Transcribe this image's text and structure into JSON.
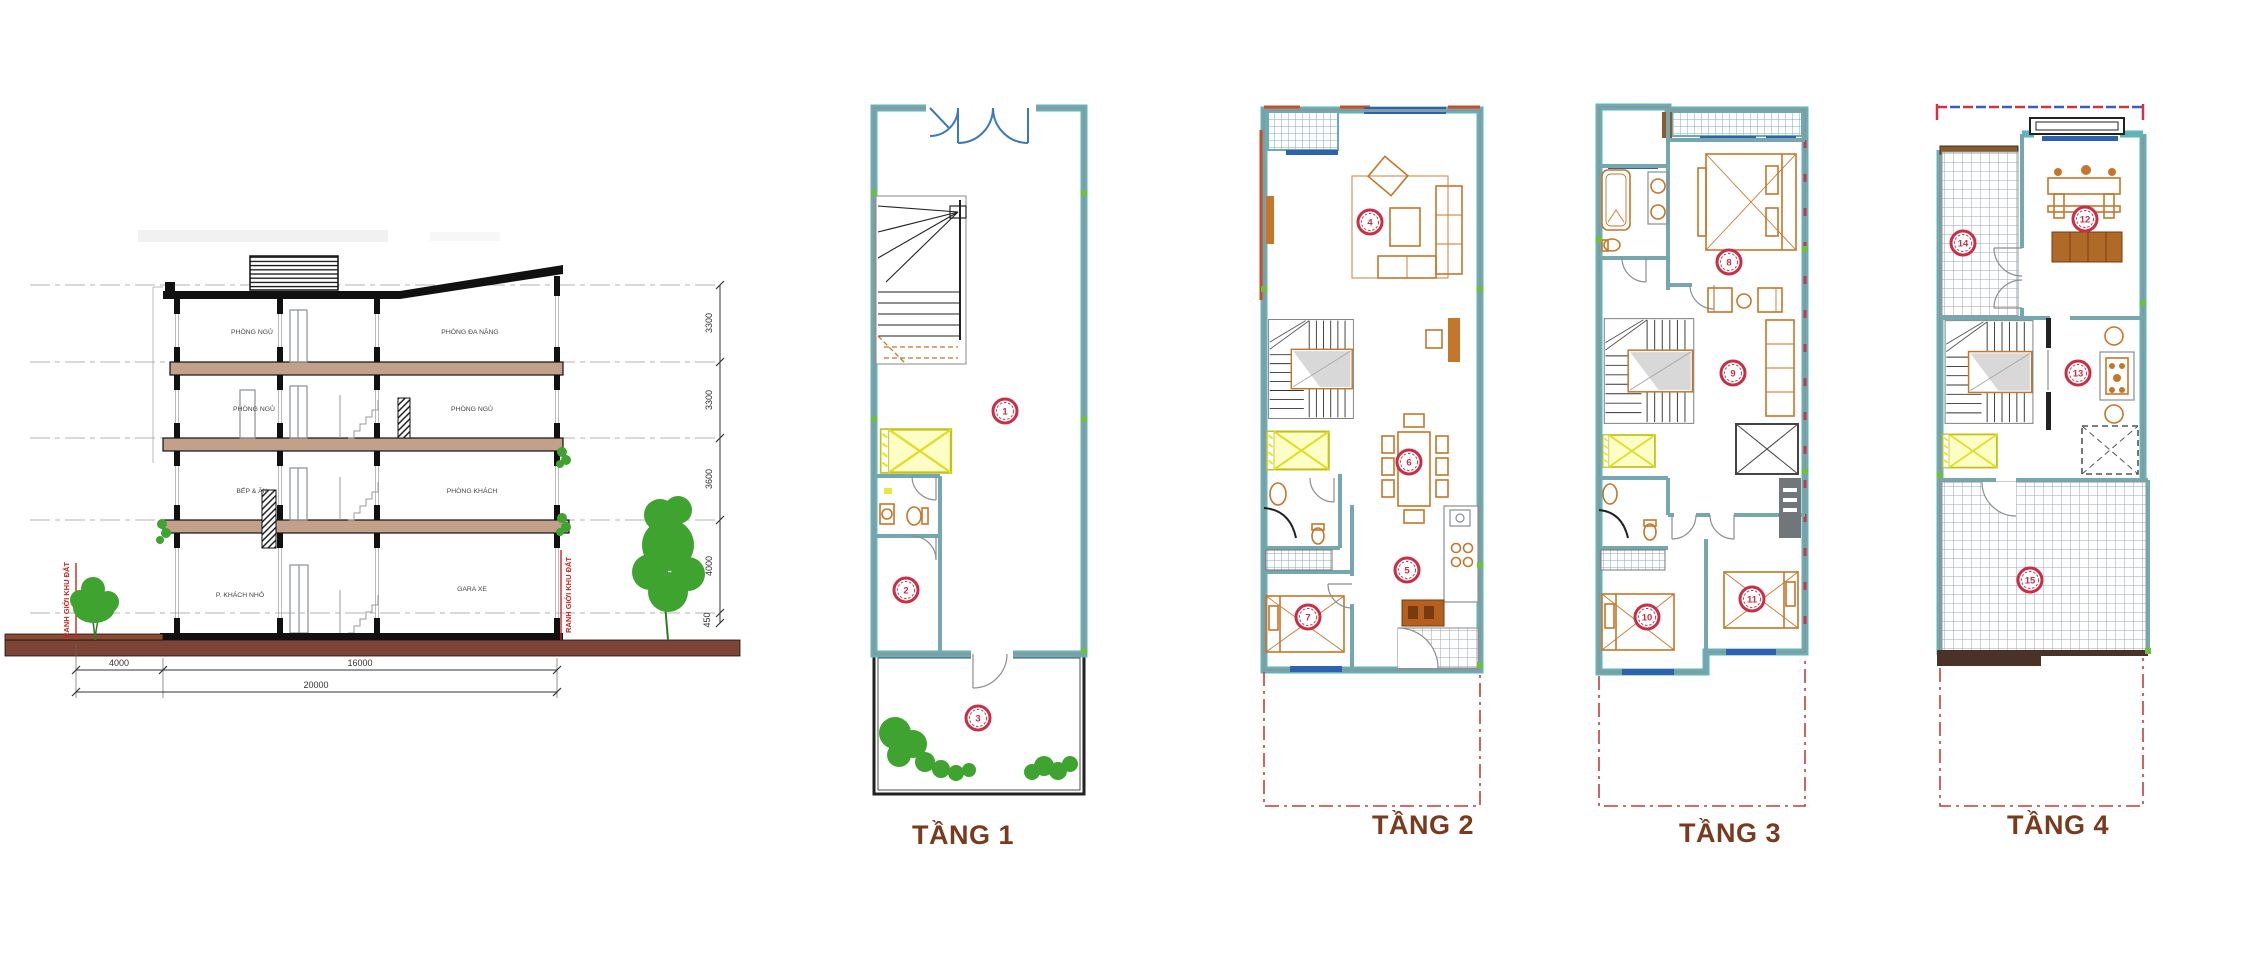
{
  "section": {
    "rooms": {
      "f4_left": "PHÒNG NGỦ",
      "f4_right": "PHÒNG ĐA NĂNG",
      "f3_left": "PHÒNG NGỦ",
      "f3_right": "PHÒNG NGỦ",
      "f2_left": "BẾP & ĂN",
      "f2_right": "PHÒNG KHÁCH",
      "f1_left": "P. KHÁCH NHỎ",
      "f1_right": "GARA XE"
    },
    "dims_h": [
      "4000",
      "16000",
      "20000"
    ],
    "dims_v": [
      "3300",
      "3300",
      "3600",
      "4000",
      "450"
    ],
    "boundary_left": "RANH GIỚI KHU ĐẤT",
    "boundary_right": "RANH GIỚI KHU ĐẤT"
  },
  "plans": [
    {
      "label": "TẦNG 1",
      "markers": [
        "1",
        "2",
        "3"
      ]
    },
    {
      "label": "TẦNG 2",
      "markers": [
        "4",
        "5",
        "6",
        "7"
      ]
    },
    {
      "label": "TẦNG 3",
      "markers": [
        "8",
        "9",
        "10",
        "11"
      ]
    },
    {
      "label": "TẦNG 4",
      "markers": [
        "12",
        "13",
        "14",
        "15"
      ]
    }
  ],
  "colors": {
    "wall_teal": "#5fb4ba",
    "wall_core": "#8b979c",
    "furniture_orange": "#c4762a",
    "marker_red": "#cb2e44",
    "boundary_red": "#d42222",
    "elevator_yellow": "#e6e600",
    "window_blue": "#2e62b0",
    "door_blue": "#3a78c0",
    "label_brown": "#7a3a1e",
    "slab_tan": "#c2a089",
    "ground_brown": "#7c4434",
    "tree_green": "#3fa32f"
  }
}
